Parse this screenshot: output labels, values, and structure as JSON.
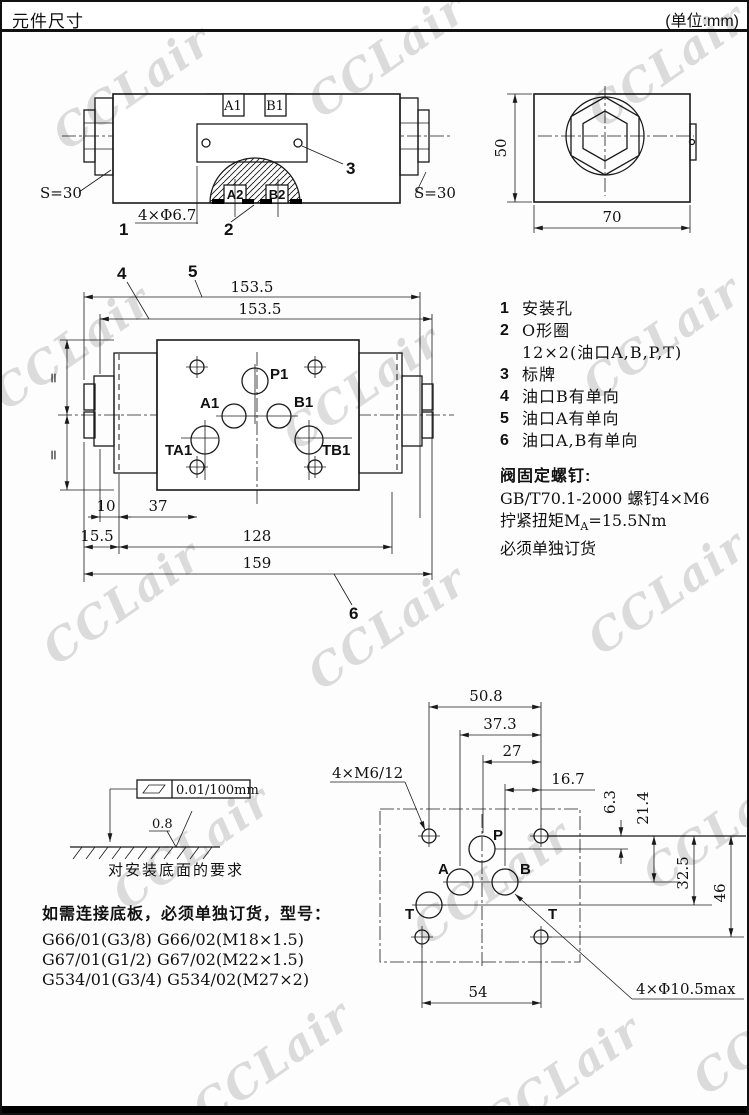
{
  "header": {
    "title": "元件尺寸",
    "unit": "(单位:mm)"
  },
  "watermark": "CCLair",
  "side_view": {
    "a1": "A1",
    "b1": "B1",
    "a2": "A2",
    "b2": "B2",
    "s_left": "S=30",
    "s_right": "S=30",
    "hole_label": "4×Φ6.7",
    "callout1": "1",
    "callout2": "2",
    "callout3": "3"
  },
  "end_view": {
    "dim_height": "50",
    "dim_width": "70"
  },
  "face_view": {
    "callout4": "4",
    "callout5": "5",
    "callout6": "6",
    "dim_153_top": "153.5",
    "dim_153_bot": "153.5",
    "p1": "P1",
    "a1": "A1",
    "b1": "B1",
    "ta1": "TA1",
    "tb1": "TB1",
    "eq_top": "=",
    "eq_bot": "=",
    "dim_10": "10",
    "dim_37": "37",
    "dim_15_5": "15.5",
    "dim_128": "128",
    "dim_159": "159"
  },
  "notes": {
    "items": [
      {
        "num": "1",
        "text": "安装孔"
      },
      {
        "num": "2",
        "text": "O形圈"
      },
      {
        "num": "",
        "text": "12×2(油口A,B,P,T)"
      },
      {
        "num": "3",
        "text": "标牌"
      },
      {
        "num": "4",
        "text": "油口B有单向"
      },
      {
        "num": "5",
        "text": "油口A有单向"
      },
      {
        "num": "6",
        "text": "油口A,B有单向"
      }
    ],
    "screw_title": "阀固定螺钉:",
    "screw_line1": "GB/T70.1-2000  螺钉4×M6",
    "torque_pre": "拧紧扭矩M",
    "torque_sub": "A",
    "torque_post": "=15.5Nm",
    "order_note": "必须单独订货"
  },
  "flatness": {
    "tolerance": "0.01/100mm",
    "roughness": "0.8",
    "caption": "对安装底面的要求"
  },
  "subplate": {
    "intro": "如需连接底板，必须单独订货，型号：",
    "models": [
      "G66/01(G3/8) G66/02(M18×1.5)",
      "G67/01(G1/2) G67/02(M22×1.5)",
      "G534/01(G3/4) G534/02(M27×2)"
    ]
  },
  "bottom_view": {
    "bolt_label": "4×M6/12",
    "port_label": "4×Φ10.5max",
    "p": "P",
    "a": "A",
    "b": "B",
    "t1": "T",
    "t2": "T",
    "dim_50_8": "50.8",
    "dim_37_3": "37.3",
    "dim_27": "27",
    "dim_16_7": "16.7",
    "dim_6_3": "6.3",
    "dim_21_4": "21.4",
    "dim_32_5": "32.5",
    "dim_46": "46",
    "dim_54": "54"
  }
}
